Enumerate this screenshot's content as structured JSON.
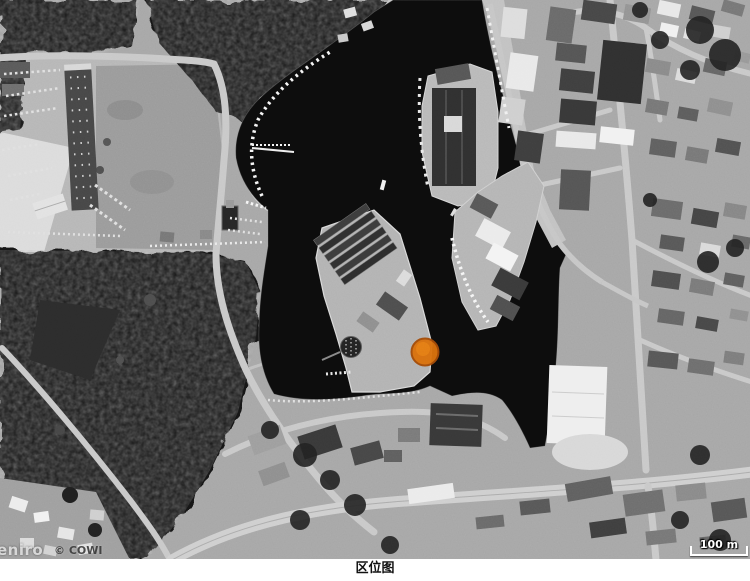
{
  "figure": {
    "caption": "区位图"
  },
  "map": {
    "attribution": {
      "brand": "eniro",
      "copyright": "© COWI"
    },
    "scalebar": {
      "label": "100 m"
    },
    "marker": {
      "color": "#d96f0c"
    }
  }
}
